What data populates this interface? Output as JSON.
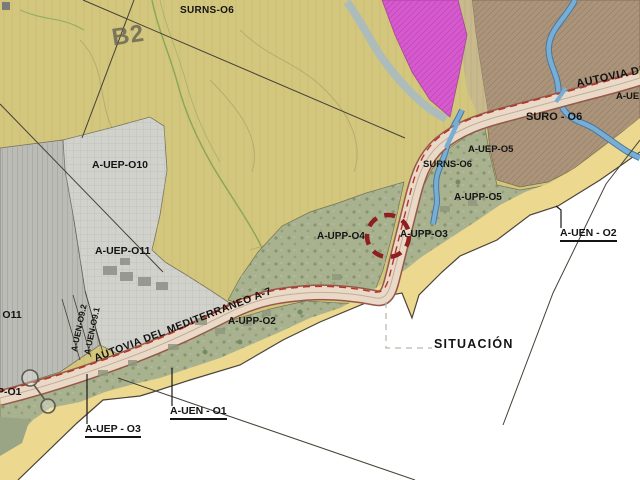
{
  "map": {
    "title_context": "planning situation map",
    "colors": {
      "tan": "#d3c67d",
      "gray_dark": "#bcbcb6",
      "gray_light": "#d2d2cd",
      "green_band": "#a9b28f",
      "brown": "#ab947b",
      "brown_trans": "#c9ba8e",
      "magenta": "#d55ace",
      "sand": "#ecd88e",
      "sea": "#ffffff",
      "road_fill": "#ead9c6",
      "road_edge": "#96584a",
      "red_dash": "#b5342a",
      "river": "#79aed4",
      "circle_red": "#8e1f1f",
      "line": "#454137",
      "label": "#141414"
    },
    "labels": {
      "surns_o6_top": {
        "text": "SURNS-O6"
      },
      "b2_watermark": {
        "text": "B2"
      },
      "a_uep_o10": {
        "text": "A-UEP-O10"
      },
      "a_uep_o11": {
        "text": "A-UEP-O11"
      },
      "o11_partial": {
        "text": "- O11"
      },
      "a_uen_o9_2": {
        "text": "A-UEN-O9.2"
      },
      "a_uen_o9_1": {
        "text": "A-UEN-O9.1"
      },
      "p_o1_partial": {
        "text": "P-O1"
      },
      "autovia_mediterraneo": {
        "text": "AUTOVIA DEL MEDITERRANEO A-7"
      },
      "a_upp_o2": {
        "text": "A-UPP-O2"
      },
      "a_upp_o4": {
        "text": "A-UPP-O4"
      },
      "a_upp_o3": {
        "text": "A-UPP-O3"
      },
      "a_upp_o5": {
        "text": "A-UPP-O5"
      },
      "surns_o6_mid": {
        "text": "SURNS-O6"
      },
      "a_uep_o5": {
        "text": "A-UEP-O5"
      },
      "suro_o6": {
        "text": "SURO - O6"
      },
      "autovia_de": {
        "text": "AUTOVIA DE"
      },
      "a_ue_partial": {
        "text": "A-UE"
      },
      "a_uen_o2": {
        "text": "A-UEN - O2"
      },
      "a_uen_o1": {
        "text": "A-UEN - O1"
      },
      "a_uep_o3_callout": {
        "text": "A-UEP - O3"
      },
      "situacion": {
        "text": "SITUACIÓN"
      }
    }
  }
}
